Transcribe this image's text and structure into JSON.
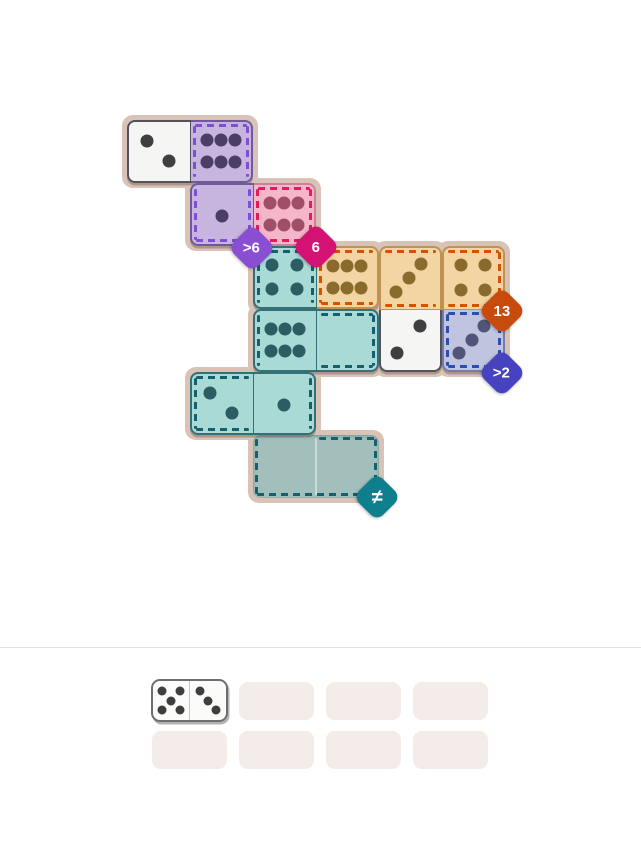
{
  "board": {
    "mat_color": "#d9c2b6",
    "palette": {
      "white": {
        "fill": "#f5f5f4",
        "edge": "#52525a",
        "pip": "#3f3f3f",
        "dash": "none"
      },
      "purple": {
        "fill": "#c7b5e0",
        "edge": "#6d5a96",
        "pip": "#4c3d66",
        "dash": "#7e4fd2"
      },
      "pink": {
        "fill": "#f6b6c9",
        "edge": "#cf7f99",
        "pip": "#a04f68",
        "dash": "#e8195f"
      },
      "teal": {
        "fill": "#a9dad6",
        "edge": "#357077",
        "pip": "#2b5d62",
        "dash": "#15606e"
      },
      "tan": {
        "fill": "#f2d5a2",
        "edge": "#bd9355",
        "pip": "#8a6b2d",
        "dash": "#d45200"
      },
      "peri": {
        "fill": "#c1c4df",
        "edge": "#767ca8",
        "pip": "#50567a",
        "dash": "#2c4fae"
      },
      "teal_empty": {
        "fill": "#a3bfbc"
      }
    },
    "tiles": [
      {
        "name": "placed-domino-2-6",
        "col": 0,
        "row": 0,
        "dir": "h",
        "halves": [
          {
            "color": "white",
            "pips": 2,
            "layout": "2a",
            "dashes": []
          },
          {
            "color": "purple",
            "pips": 6,
            "layout": "6",
            "dashes": [
              "top",
              "left",
              "right"
            ]
          }
        ]
      },
      {
        "name": "placed-domino-1-6",
        "col": 1,
        "row": 1,
        "dir": "h",
        "halves": [
          {
            "color": "purple",
            "pips": 1,
            "layout": "1",
            "dashes": [
              "left",
              "bottom",
              "right"
            ]
          },
          {
            "color": "pink",
            "pips": 6,
            "layout": "6",
            "dashes": [
              "top",
              "left",
              "right",
              "bottom"
            ]
          }
        ]
      },
      {
        "name": "placed-domino-4-6",
        "col": 2,
        "row": 2,
        "dir": "h",
        "halves": [
          {
            "color": "teal",
            "pips": 4,
            "layout": "4",
            "dashes": [
              "top",
              "left",
              "right"
            ]
          },
          {
            "color": "tan",
            "pips": 6,
            "layout": "6",
            "dashes": [
              "top",
              "left",
              "bottom"
            ]
          }
        ]
      },
      {
        "name": "placed-domino-3-2",
        "col": 4,
        "row": 2,
        "dir": "v",
        "halves": [
          {
            "color": "tan",
            "pips": 3,
            "layout": "3b",
            "dashes": [
              "top",
              "bottom"
            ]
          },
          {
            "color": "white",
            "pips": 2,
            "layout": "2b",
            "dashes": []
          }
        ]
      },
      {
        "name": "placed-domino-4-3",
        "col": 5,
        "row": 2,
        "dir": "v",
        "halves": [
          {
            "color": "tan",
            "pips": 4,
            "layout": "4",
            "dashes": [
              "top",
              "right",
              "bottom"
            ]
          },
          {
            "color": "peri",
            "pips": 3,
            "layout": "3b",
            "dashes": [
              "top",
              "left",
              "right",
              "bottom"
            ]
          }
        ]
      },
      {
        "name": "placed-domino-6-0",
        "col": 2,
        "row": 3,
        "dir": "h",
        "halves": [
          {
            "color": "teal",
            "pips": 6,
            "layout": "6",
            "dashes": [
              "left"
            ]
          },
          {
            "color": "teal",
            "pips": 0,
            "layout": "0",
            "dashes": [
              "top",
              "right",
              "bottom"
            ]
          }
        ]
      },
      {
        "name": "placed-domino-2-1",
        "col": 1,
        "row": 4,
        "dir": "h",
        "halves": [
          {
            "color": "teal",
            "pips": 2,
            "layout": "2a",
            "dashes": [
              "top",
              "left",
              "bottom"
            ]
          },
          {
            "color": "teal",
            "pips": 1,
            "layout": "1",
            "dashes": [
              "right"
            ]
          }
        ]
      }
    ],
    "empty_region": {
      "color": "teal_empty",
      "dash_color": "#15606e",
      "col": 2,
      "row": 5,
      "cells": 2,
      "dashes": [
        "left",
        "bottom",
        "right",
        "top-right-half"
      ]
    },
    "badges": [
      {
        "name": "constraint-badge-gt6",
        "label": ">6",
        "color": "#8a4ed2",
        "x": 252,
        "y": 248
      },
      {
        "name": "constraint-badge-6",
        "label": "6",
        "color": "#d31274",
        "x": 316,
        "y": 247
      },
      {
        "name": "constraint-badge-13",
        "label": "13",
        "color": "#c74b0c",
        "x": 502,
        "y": 311
      },
      {
        "name": "constraint-badge-gt2",
        "label": ">2",
        "color": "#4742c0",
        "x": 502,
        "y": 373
      },
      {
        "name": "constraint-badge-neq",
        "label": "≠",
        "color": "#0f7f8e",
        "x": 377,
        "y": 497
      }
    ]
  },
  "tray": {
    "slot_color": "#f4ece8",
    "slot_count": 8,
    "columns": 4,
    "dominoes": [
      {
        "name": "tray-domino-5-3",
        "slot": 0,
        "left_pips": 5,
        "right_pips": 3,
        "left_layout": "5",
        "right_layout": "3a"
      }
    ]
  }
}
